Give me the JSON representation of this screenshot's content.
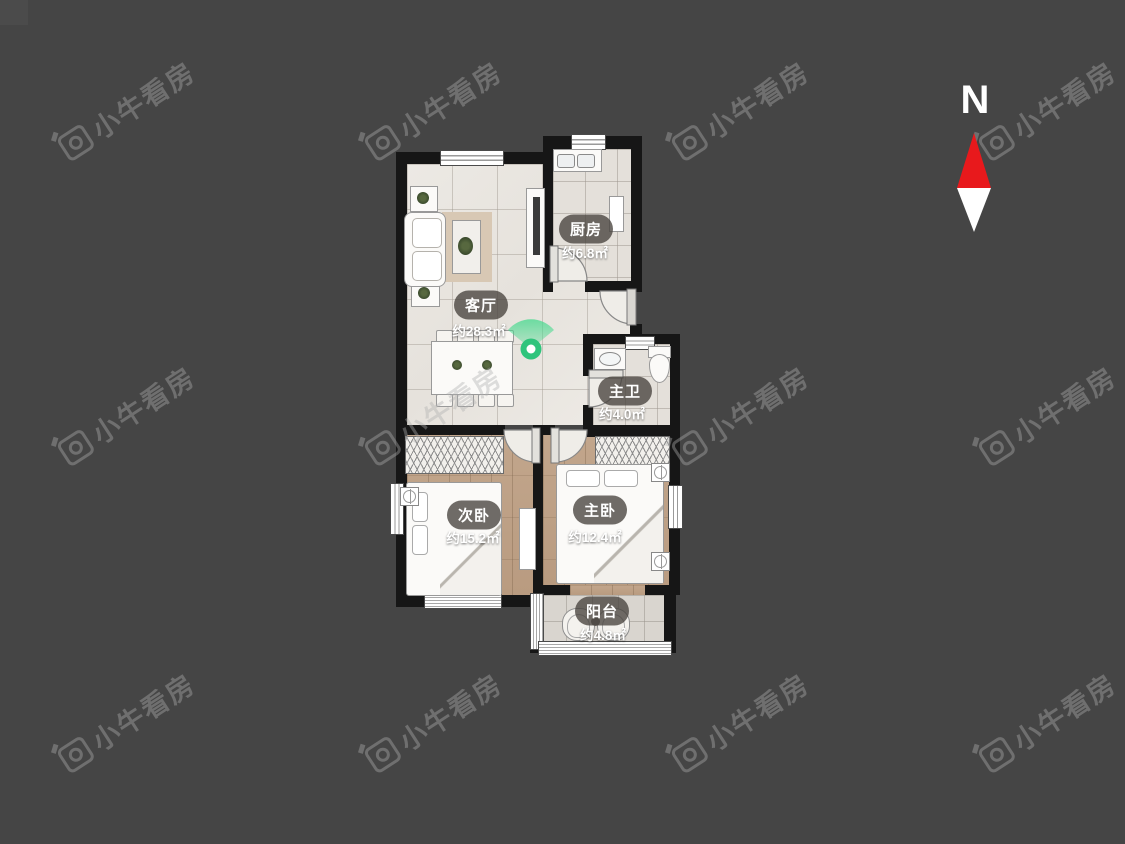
{
  "app": {
    "watermark_text": "小牛看房"
  },
  "compass": {
    "label": "N"
  },
  "floor_plan": {
    "rooms": [
      {
        "name": "客厅",
        "area": "约28.3㎡"
      },
      {
        "name": "厨房",
        "area": "约6.8㎡"
      },
      {
        "name": "主卫",
        "area": "约4.0㎡"
      },
      {
        "name": "次卧",
        "area": "约15.2㎡"
      },
      {
        "name": "主卧",
        "area": "约12.4㎡"
      },
      {
        "name": "阳台",
        "area": "约4.8㎡"
      }
    ]
  },
  "colors": {
    "background": "#454545",
    "wall": "#161616",
    "accent_green": "#2fc47c",
    "compass_red": "#e8191c"
  }
}
